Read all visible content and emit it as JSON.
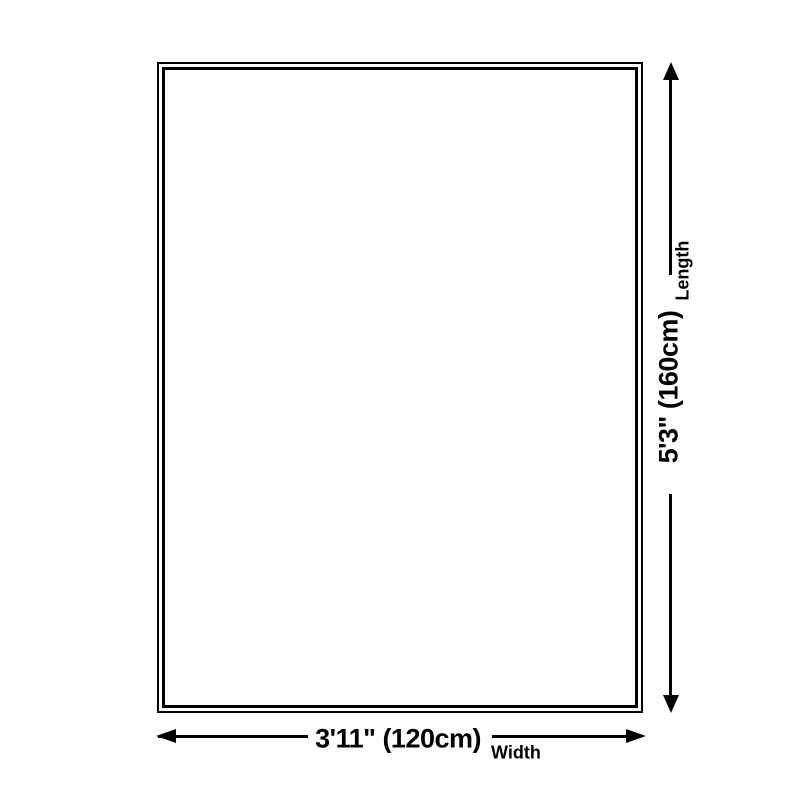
{
  "dimensions": {
    "length": {
      "value": "5'3\" (160cm)",
      "label": "Length"
    },
    "width": {
      "value": "3'11\" (120cm)",
      "label": "Width"
    }
  },
  "colors": {
    "line": "#000000",
    "background": "#ffffff"
  }
}
